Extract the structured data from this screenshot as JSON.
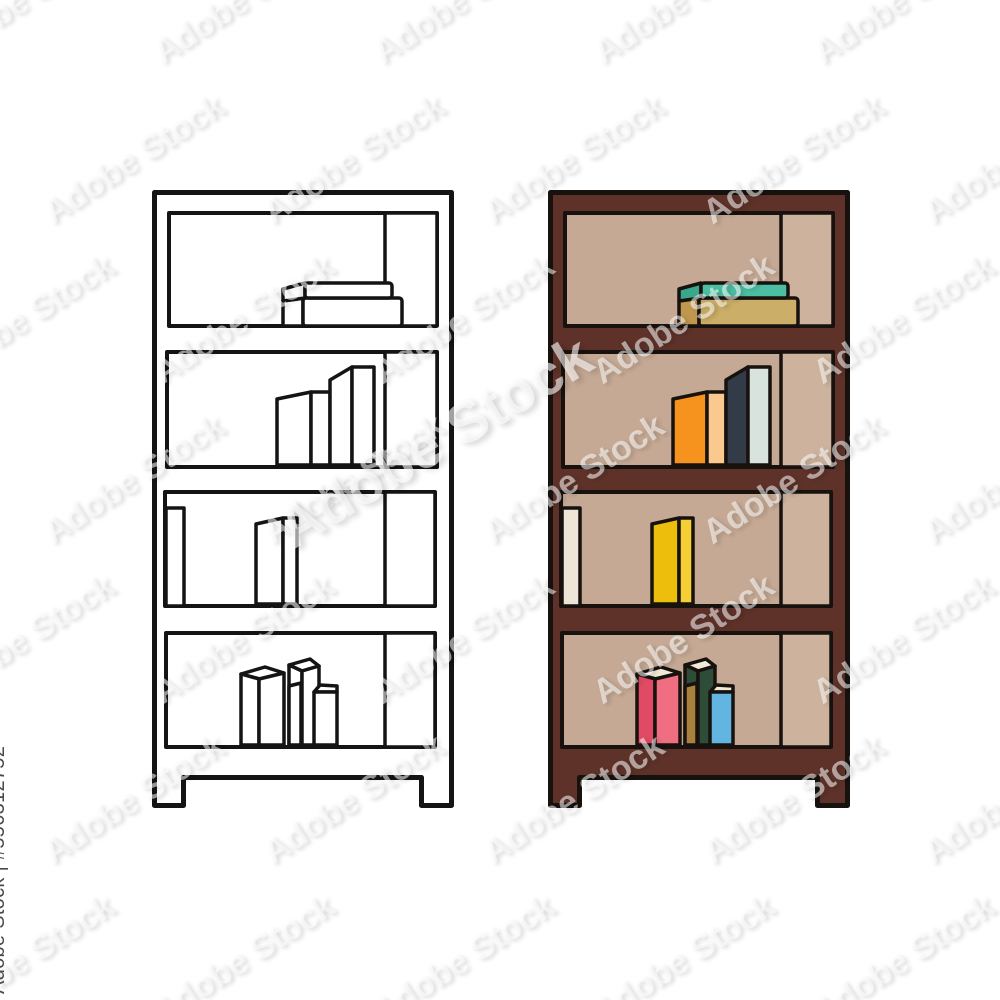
{
  "page": {
    "background": "#ffffff",
    "subject": "Bookcase with books on four shelves, outline version (left) and colored version (right)"
  },
  "watermark": {
    "tile_text": "Adobe Stock",
    "center_text": "Adobe Stock",
    "side_label": "Adobe Stock | #556312752",
    "side_label_color": "#4a4a4a"
  },
  "units": [
    {
      "id": "outline",
      "label": "outline bookcase",
      "colors": {
        "frame": "#ffffff",
        "interior": "#ffffff",
        "panel": "#ffffff",
        "stroke": "#141414",
        "s1_top_front": "#ffffff",
        "s1_top_end": "#ffffff",
        "s1_bot_front": "#ffffff",
        "s1_bot_end": "#ffffff",
        "s2_b1_front": "#ffffff",
        "s2_b1_spine": "#ffffff",
        "s2_b2_front": "#ffffff",
        "s2_b2_spine": "#ffffff",
        "s3_left": "#ffffff",
        "s3_front": "#ffffff",
        "s3_spine": "#ffffff",
        "s4_pink_front": "#ffffff",
        "s4_pink_spine": "#ffffff",
        "s4_mustard": "#ffffff",
        "s4_green": "#ffffff",
        "s4_blue": "#ffffff",
        "pages": "#ffffff"
      }
    },
    {
      "id": "colored",
      "label": "colored bookcase",
      "colors": {
        "frame": "#5e3229",
        "interior": "#c5a994",
        "panel": "#cdb39d",
        "stroke": "#18120e",
        "s1_top_front": "#4cbfa2",
        "s1_top_end": "#3aa78c",
        "s1_bot_front": "#cbae67",
        "s1_bot_end": "#c0974f",
        "s2_b1_front": "#f6921e",
        "s2_b1_spine": "#fac98e",
        "s2_b2_front": "#333a48",
        "s2_b2_spine": "#d9e3dd",
        "s3_left": "#ede5d5",
        "s3_front": "#eebe0d",
        "s3_spine": "#f6cf35",
        "s4_pink_front": "#e04a64",
        "s4_pink_spine": "#ef6e81",
        "s4_mustard": "#a8823c",
        "s4_green": "#2e4d39",
        "s4_blue": "#62b5e1",
        "pages": "#f1ead9"
      }
    }
  ]
}
